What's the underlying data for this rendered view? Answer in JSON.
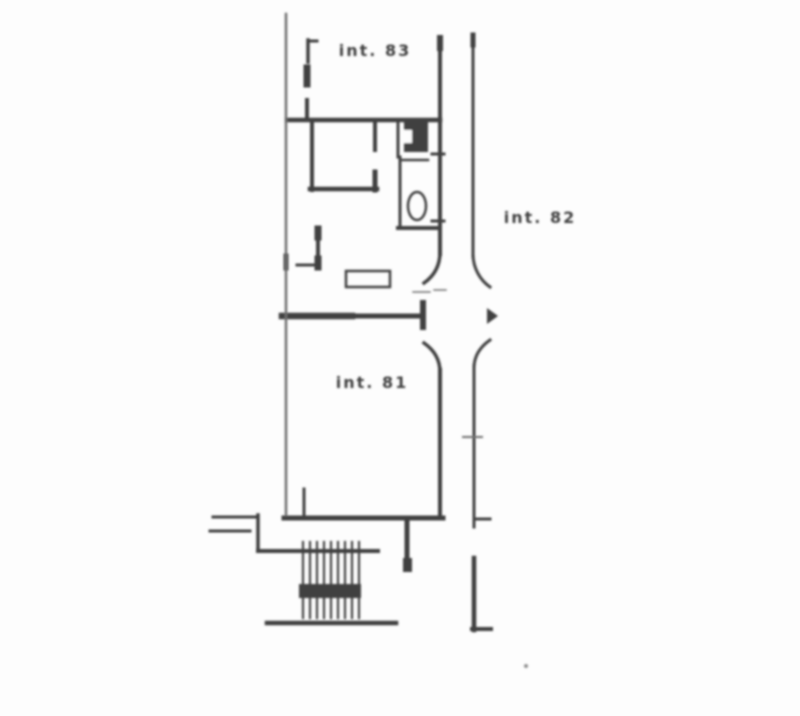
{
  "plan": {
    "labels": {
      "unit_top": "int. 83",
      "unit_mid_right": "int. 82",
      "unit_lower": "int. 81"
    },
    "ink_color": "#3f3f3f",
    "light_ink_color": "#6e6e6e",
    "faint_ink_color": "#8f8f8f",
    "paper_color": "#fdfdfd"
  }
}
